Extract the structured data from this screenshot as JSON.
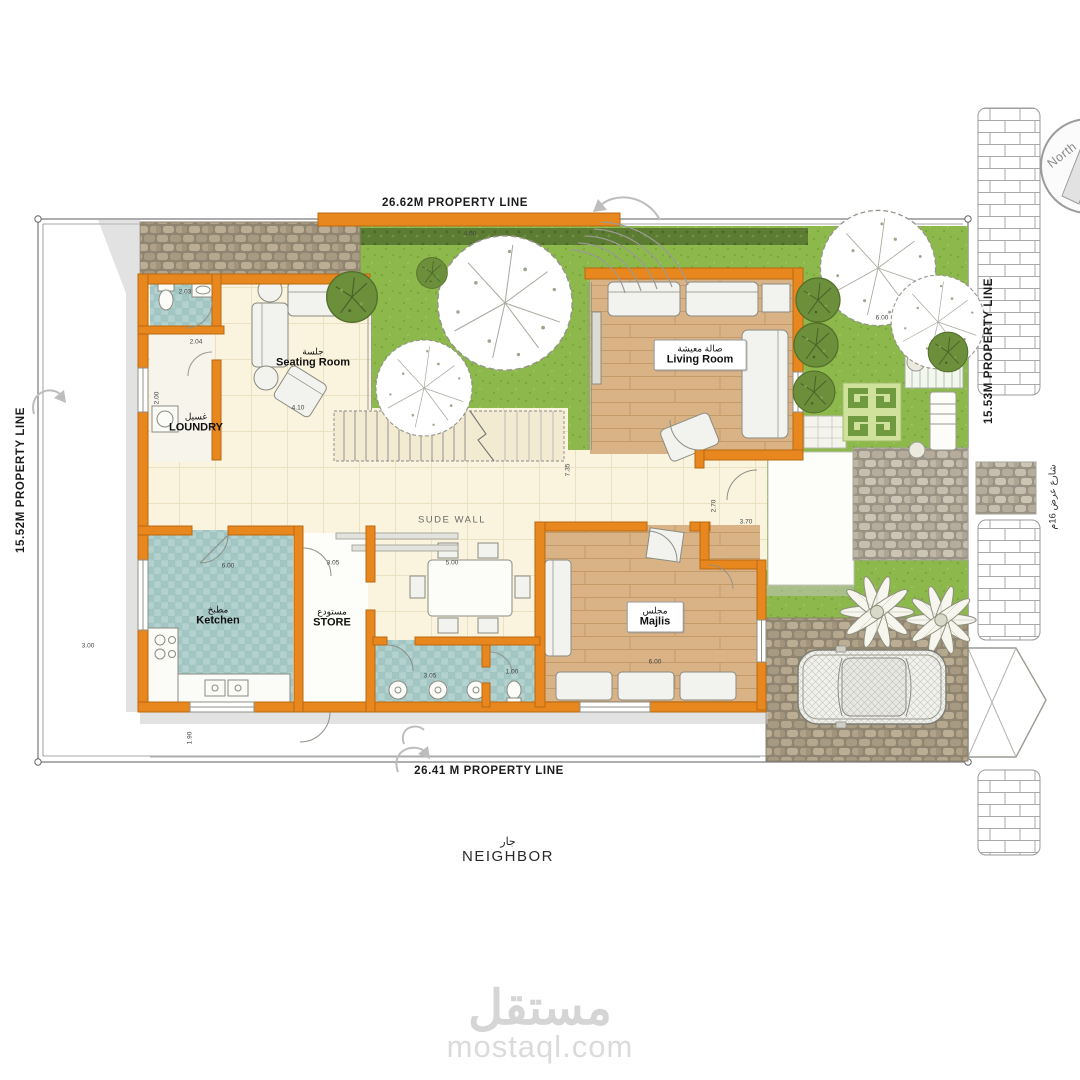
{
  "plan": {
    "property": {
      "top_label": "26.62M PROPERTY LINE",
      "bottom_label": "26.41 M PROPERTY LINE",
      "left_label": "15.52M PROPERTY LINE",
      "right_label": "15.53M PROPERTY LINE"
    },
    "compass": {
      "label": "North"
    },
    "street": {
      "label_ar": "شارع عرض 16م"
    },
    "neighbor": {
      "ar": "جار",
      "en": "NEIGHBOR"
    },
    "wall_note": "SUDE WALL",
    "rooms": [
      {
        "id": "seating",
        "ar": "جلسة",
        "en": "Seating Room"
      },
      {
        "id": "living",
        "ar": "صالة معيشة",
        "en": "Living Room"
      },
      {
        "id": "loundry",
        "ar": "غسيل",
        "en": "LOUNDRY"
      },
      {
        "id": "kitchen",
        "ar": "مطبخ",
        "en": "Ketchen"
      },
      {
        "id": "store",
        "ar": "مستودع",
        "en": "STORE"
      },
      {
        "id": "majlis",
        "ar": "مجلس",
        "en": "Majlis"
      }
    ],
    "dims": [
      {
        "t": "4.00",
        "x": 470,
        "y": 234,
        "r": 0
      },
      {
        "t": "6.00",
        "x": 882,
        "y": 318,
        "r": 0
      },
      {
        "t": "2.03",
        "x": 185,
        "y": 292,
        "r": 0
      },
      {
        "t": "2.04",
        "x": 196,
        "y": 342,
        "r": 0
      },
      {
        "t": "2.00",
        "x": 157,
        "y": 398,
        "r": -90
      },
      {
        "t": "4.10",
        "x": 298,
        "y": 408,
        "r": 0
      },
      {
        "t": "6.00",
        "x": 228,
        "y": 566,
        "r": 0
      },
      {
        "t": "3.05",
        "x": 333,
        "y": 563,
        "r": 0
      },
      {
        "t": "5.00",
        "x": 452,
        "y": 563,
        "r": 0
      },
      {
        "t": "6.00",
        "x": 655,
        "y": 662,
        "r": 0
      },
      {
        "t": "3.05",
        "x": 430,
        "y": 676,
        "r": 0
      },
      {
        "t": "1.00",
        "x": 512,
        "y": 672,
        "r": 0
      },
      {
        "t": "7.35",
        "x": 568,
        "y": 470,
        "r": -90
      },
      {
        "t": "2.70",
        "x": 714,
        "y": 506,
        "r": -90
      },
      {
        "t": "3.70",
        "x": 746,
        "y": 522,
        "r": 0
      },
      {
        "t": "3.00",
        "x": 88,
        "y": 646,
        "r": 0
      },
      {
        "t": "1.90",
        "x": 190,
        "y": 738,
        "r": -90
      }
    ],
    "colors": {
      "wall_orange": "#E8871E",
      "wall_outline": "#B96A12",
      "grass": "#8CB84C",
      "hedge_dark": "#5D7C33",
      "tile_teal": "#A8CBC8",
      "floor_cream": "#FAF3DE",
      "wood": "#D8B287",
      "cobble": "#B6A88E",
      "shadow": "#C6C6C6",
      "watermark": "#D5D5D5"
    }
  },
  "watermark": {
    "logo": "مستقل",
    "site": "mostaql.com"
  }
}
